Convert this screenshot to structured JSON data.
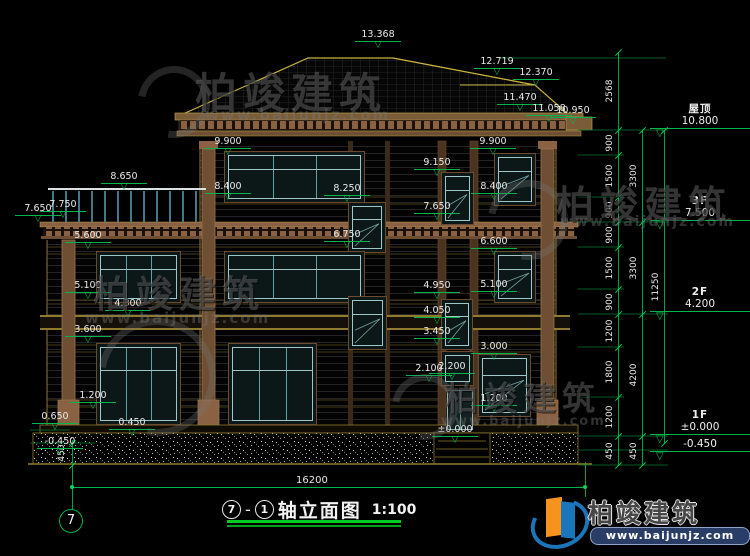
{
  "drawing": {
    "title": {
      "axis_start": "7",
      "sep": "-",
      "axis_end": "1",
      "name": "轴立面图",
      "scale": "1:100"
    },
    "axis_bubble": "7",
    "bottom_dim": "16200",
    "left_foundation_dim": "450"
  },
  "floor_markers": [
    {
      "name": "屋顶",
      "value": "10.800",
      "y": 130
    },
    {
      "name": "3F",
      "value": "7.500",
      "y": 222
    },
    {
      "name": "2F",
      "value": "4.200",
      "y": 313
    },
    {
      "name": "1F",
      "value": "±0.000",
      "y": 436
    },
    {
      "name": "",
      "value": "-0.450",
      "y": 452
    }
  ],
  "elevation_markers": [
    {
      "label": "13.368",
      "x": 378,
      "y": 30
    },
    {
      "label": "12.719",
      "x": 497,
      "y": 57
    },
    {
      "label": "12.370",
      "x": 536,
      "y": 68
    },
    {
      "label": "11.470",
      "x": 520,
      "y": 93
    },
    {
      "label": "11.058",
      "x": 549,
      "y": 104
    },
    {
      "label": "10.950",
      "x": 573,
      "y": 106
    },
    {
      "label": "9.900",
      "x": 228,
      "y": 137
    },
    {
      "label": "9.900",
      "x": 493,
      "y": 137
    },
    {
      "label": "9.150",
      "x": 437,
      "y": 158
    },
    {
      "label": "8.650",
      "x": 124,
      "y": 172
    },
    {
      "label": "8.400",
      "x": 228,
      "y": 182
    },
    {
      "label": "8.400",
      "x": 494,
      "y": 182
    },
    {
      "label": "8.250",
      "x": 347,
      "y": 184
    },
    {
      "label": "7.750",
      "x": 63,
      "y": 200
    },
    {
      "label": "7.650",
      "x": 38,
      "y": 204
    },
    {
      "label": "7.650",
      "x": 437,
      "y": 202
    },
    {
      "label": "6.750",
      "x": 347,
      "y": 230
    },
    {
      "label": "6.600",
      "x": 494,
      "y": 237
    },
    {
      "label": "5.600",
      "x": 88,
      "y": 231
    },
    {
      "label": "5.100",
      "x": 88,
      "y": 281
    },
    {
      "label": "5.100",
      "x": 494,
      "y": 280
    },
    {
      "label": "4.950",
      "x": 437,
      "y": 281
    },
    {
      "label": "4.300",
      "x": 128,
      "y": 299
    },
    {
      "label": "4.050",
      "x": 437,
      "y": 306
    },
    {
      "label": "3.600",
      "x": 88,
      "y": 325
    },
    {
      "label": "3.450",
      "x": 437,
      "y": 327
    },
    {
      "label": "3.000",
      "x": 494,
      "y": 342
    },
    {
      "label": "2.100",
      "x": 429,
      "y": 364
    },
    {
      "label": "2.200",
      "x": 452,
      "y": 362
    },
    {
      "label": "1.200",
      "x": 93,
      "y": 391
    },
    {
      "label": "1.200",
      "x": 494,
      "y": 394
    },
    {
      "label": "±0.000",
      "x": 455,
      "y": 425
    },
    {
      "label": "0.650",
      "x": 55,
      "y": 412
    },
    {
      "label": "0.450",
      "x": 132,
      "y": 418
    },
    {
      "label": "-0.450",
      "x": 60,
      "y": 437
    }
  ],
  "chains": [
    {
      "x": 618,
      "segments": [
        {
          "label": "2568",
          "y1": 52,
          "y2": 130
        },
        {
          "label": "900",
          "y1": 130,
          "y2": 155
        },
        {
          "label": "1500",
          "y1": 155,
          "y2": 197
        },
        {
          "label": "900",
          "y1": 197,
          "y2": 222
        },
        {
          "label": "900",
          "y1": 222,
          "y2": 247
        },
        {
          "label": "1500",
          "y1": 247,
          "y2": 289
        },
        {
          "label": "900",
          "y1": 289,
          "y2": 314
        },
        {
          "label": "1200",
          "y1": 314,
          "y2": 347
        },
        {
          "label": "1800",
          "y1": 347,
          "y2": 397
        },
        {
          "label": "1200",
          "y1": 397,
          "y2": 436
        },
        {
          "label": "450",
          "y1": 436,
          "y2": 465
        }
      ]
    },
    {
      "x": 642,
      "segments": [
        {
          "label": "3300",
          "y1": 130,
          "y2": 222
        },
        {
          "label": "3300",
          "y1": 222,
          "y2": 314
        },
        {
          "label": "4200",
          "y1": 314,
          "y2": 436
        },
        {
          "label": "450",
          "y1": 436,
          "y2": 465
        }
      ]
    },
    {
      "x": 664,
      "segments": [
        {
          "label": "11250",
          "y1": 130,
          "y2": 443
        }
      ]
    }
  ],
  "watermark": {
    "name": "柏竣建筑",
    "url": "www.baijunjz.com"
  },
  "logo": {
    "name": "柏竣建筑",
    "url": "www.baijunjz.com"
  },
  "colors": {
    "dim_green": "#00b44c",
    "line_yellow": "#a3892f",
    "trim_tan": "#8a6243",
    "window_teal": "#9fc7c7",
    "text": "#e8e8e8",
    "title_underline": "#00cc22"
  }
}
